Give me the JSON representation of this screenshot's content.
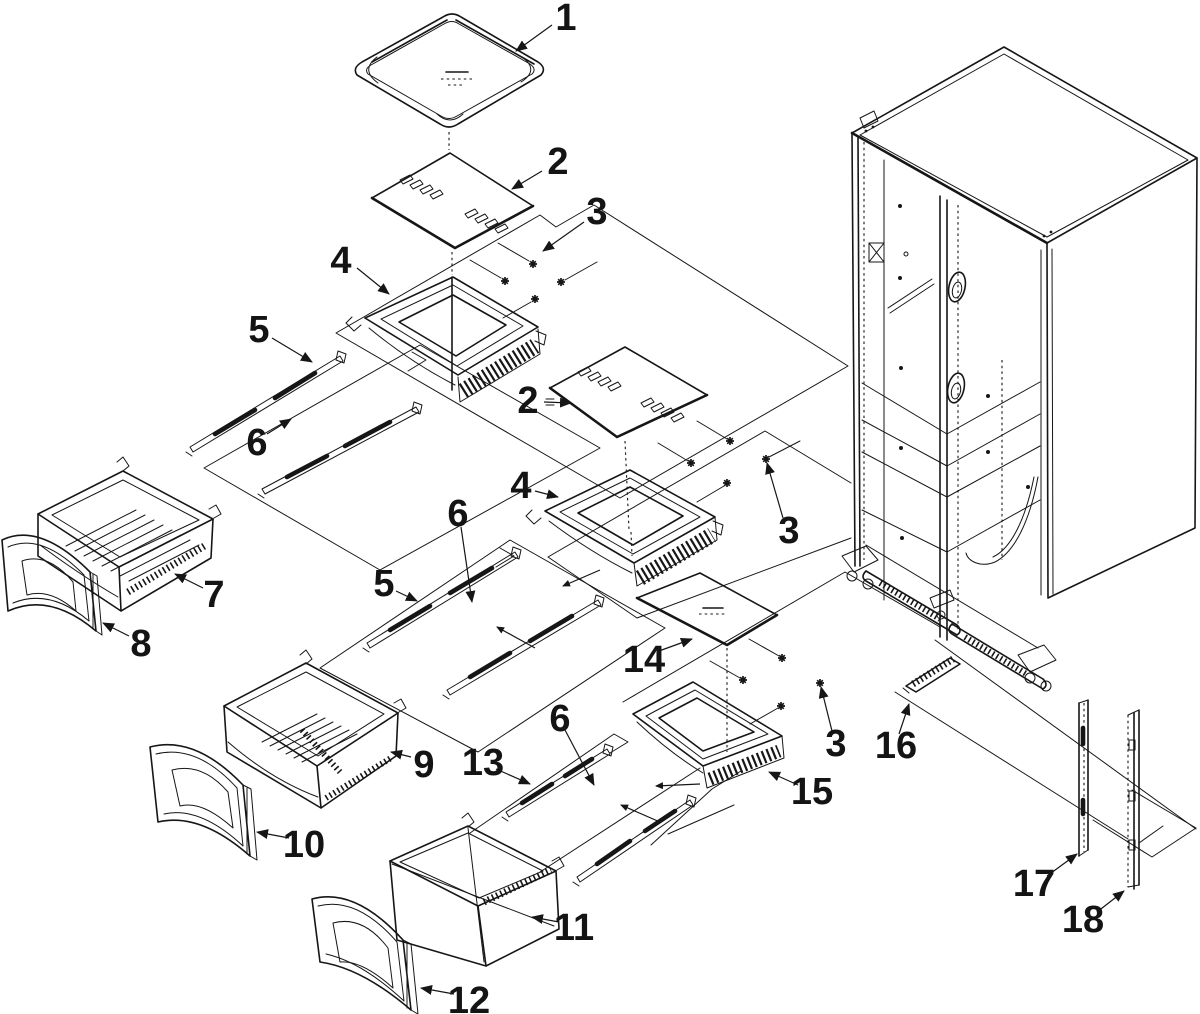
{
  "diagram": {
    "type": "exploded-parts-diagram",
    "colors": {
      "background": "#ffffff",
      "ink": "#161616"
    },
    "callouts": [
      {
        "label": "1"
      },
      {
        "label": "2"
      },
      {
        "label": "3"
      },
      {
        "label": "4"
      },
      {
        "label": "5"
      },
      {
        "label": "6"
      },
      {
        "label": "2"
      },
      {
        "label": "4"
      },
      {
        "label": "3"
      },
      {
        "label": "5"
      },
      {
        "label": "6"
      },
      {
        "label": "7"
      },
      {
        "label": "8"
      },
      {
        "label": "9"
      },
      {
        "label": "10"
      },
      {
        "label": "13"
      },
      {
        "label": "6"
      },
      {
        "label": "11"
      },
      {
        "label": "12"
      },
      {
        "label": "14"
      },
      {
        "label": "15"
      },
      {
        "label": "3"
      },
      {
        "label": "16"
      },
      {
        "label": "17"
      },
      {
        "label": "18"
      }
    ]
  }
}
